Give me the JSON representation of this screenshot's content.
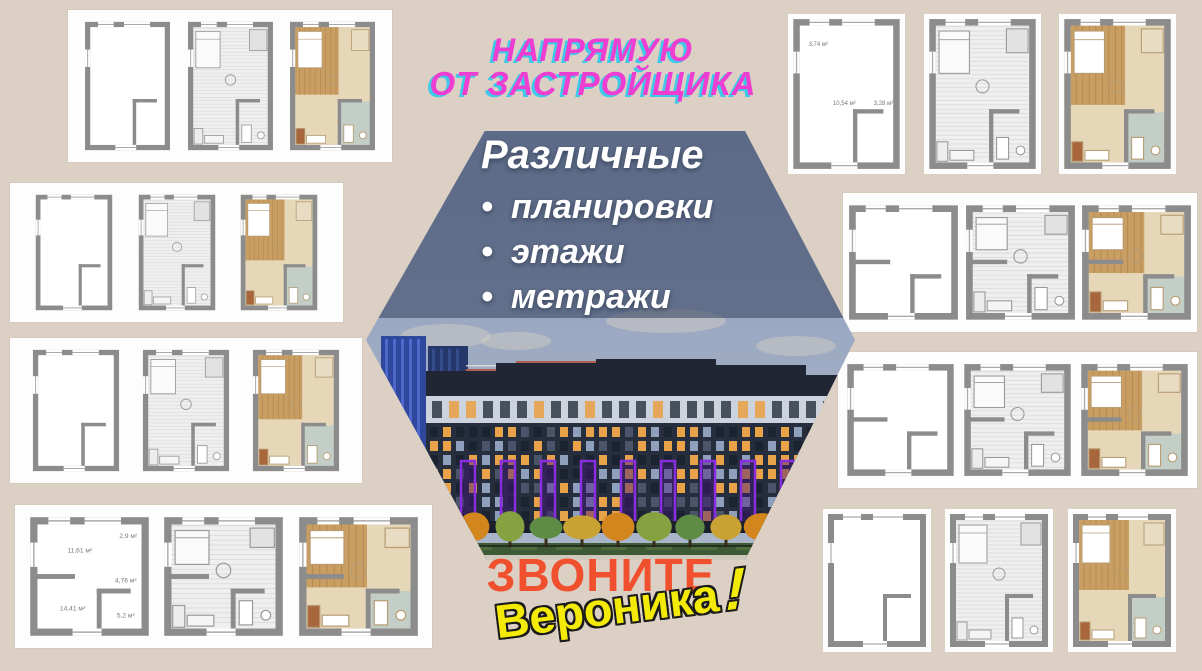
{
  "page": {
    "background": "#dccfc3"
  },
  "title": {
    "line1": "НАПРЯМУЮ",
    "line2": "ОТ ЗАСТРОЙЩИКА",
    "color": "#ee3ed2",
    "shadow_color": "#3fc9e8"
  },
  "hexagon": {
    "heading": "Различные",
    "bullet_char": "•",
    "bullets": [
      "планировки",
      "этажи",
      "метражи"
    ],
    "text_color": "#ffffff",
    "overlay_color": "rgba(56,70,100,0.58)",
    "photo": {
      "sky_top": "#8e9dba",
      "sky_bottom": "#aab6ca",
      "cloud": "#d8cfc4",
      "roof": "#202634",
      "band": "#ccd3dd",
      "band_window": "#39414f",
      "facade": "#262e3d",
      "facade_base": "#1a1f2b",
      "window_warm": "#e8a24a",
      "window_cool": "#8fa0bd",
      "window_dim": "#4a5569",
      "window_dark": "#1b2230",
      "accent_purple": "#8a2ce0",
      "accent_purple_fill": "#43197a",
      "tower_blue": "#30479e",
      "tower_blue_light": "#5571d6",
      "tower_dark": "#24386b",
      "tower_stripe": "#3b5396",
      "brick": "#b2604f",
      "brick_grid": "#e8e2da",
      "tree_colors": [
        "#c9a233",
        "#d4861e",
        "#86a13f",
        "#5f8c45"
      ],
      "trunk": "#3a2d1c",
      "lawn": "#3d5a35",
      "lawn_light": "#6f8f4a",
      "fence": "#1f261f",
      "bottom_strip": "#cfc8bc"
    }
  },
  "cta": {
    "call": "ЗВОНИТЕ",
    "call_color": "#f1502e",
    "name": "Вероника",
    "exclamation": "!",
    "name_color": "#f3eb07",
    "name_outline": "#1b1b1b"
  },
  "plans": {
    "wall_color": "#8c8c8c",
    "panel_color": "#fdfdfd",
    "groups": [
      {
        "id": "top-left",
        "panel": true,
        "x": 68,
        "y": 10,
        "w": 324,
        "h": 152,
        "plans": [
          {
            "variant": "outline",
            "vh": 150
          },
          {
            "variant": "furnished",
            "vh": 150
          },
          {
            "variant": "render",
            "vh": 150
          }
        ]
      },
      {
        "id": "left-middle",
        "panel": true,
        "x": 10,
        "y": 183,
        "w": 333,
        "h": 139,
        "plans": [
          {
            "variant": "outline",
            "vh": 150
          },
          {
            "variant": "furnished",
            "vh": 150
          },
          {
            "variant": "render",
            "vh": 150
          }
        ]
      },
      {
        "id": "left-lower",
        "panel": true,
        "x": 10,
        "y": 338,
        "w": 352,
        "h": 145,
        "plans": [
          {
            "variant": "outline",
            "vh": 140
          },
          {
            "variant": "furnished",
            "vh": 140
          },
          {
            "variant": "render",
            "vh": 140
          }
        ]
      },
      {
        "id": "bottom-left",
        "panel": true,
        "x": 15,
        "y": 505,
        "w": 417,
        "h": 143,
        "plans": [
          {
            "variant": "outline",
            "vh": 100,
            "labels": [
              {
                "text": "11,61 м²",
                "x": 42,
                "y": 30
              },
              {
                "text": "2,9 м²",
                "x": 82,
                "y": 18
              },
              {
                "text": "4,76 м²",
                "x": 80,
                "y": 55
              },
              {
                "text": "14,41 м²",
                "x": 36,
                "y": 78
              },
              {
                "text": "5,2 м²",
                "x": 80,
                "y": 84
              }
            ]
          },
          {
            "variant": "furnished",
            "vh": 100
          },
          {
            "variant": "render",
            "vh": 100
          }
        ]
      },
      {
        "id": "top-right",
        "panel": false,
        "x": 770,
        "y": 8,
        "w": 424,
        "h": 172,
        "plans": [
          {
            "variant": "outline",
            "vh": 140,
            "labels": [
              {
                "text": "3,74 м²",
                "x": 24,
                "y": 26
              },
              {
                "text": "10,54 м²",
                "x": 48,
                "y": 80
              },
              {
                "text": "3,28 м²",
                "x": 84,
                "y": 80
              }
            ]
          },
          {
            "variant": "furnished",
            "vh": 140
          },
          {
            "variant": "render",
            "vh": 140
          }
        ]
      },
      {
        "id": "right-middle",
        "panel": true,
        "x": 843,
        "y": 193,
        "w": 354,
        "h": 139,
        "plans": [
          {
            "variant": "outline",
            "vh": 105
          },
          {
            "variant": "furnished",
            "vh": 105
          },
          {
            "variant": "render",
            "vh": 105
          }
        ]
      },
      {
        "id": "right-lower",
        "panel": true,
        "x": 838,
        "y": 352,
        "w": 359,
        "h": 136,
        "plans": [
          {
            "variant": "outline",
            "vh": 105
          },
          {
            "variant": "furnished",
            "vh": 105
          },
          {
            "variant": "render",
            "vh": 105
          }
        ]
      },
      {
        "id": "bottom-right",
        "panel": false,
        "x": 808,
        "y": 503,
        "w": 382,
        "h": 155,
        "plans": [
          {
            "variant": "outline",
            "vh": 135
          },
          {
            "variant": "furnished",
            "vh": 135
          },
          {
            "variant": "render",
            "vh": 135
          }
        ]
      }
    ]
  }
}
